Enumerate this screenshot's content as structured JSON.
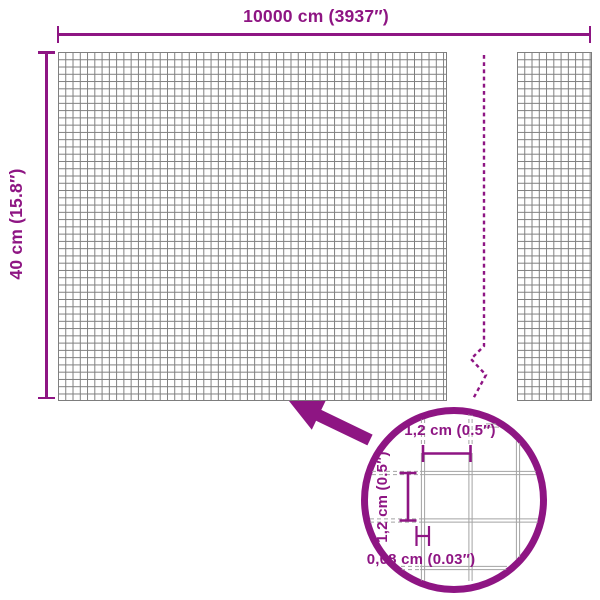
{
  "colors": {
    "brand": "#8e1583",
    "mesh-line": "#7d7d7d",
    "zoom-mesh-line": "#a3a3a3"
  },
  "diagram": {
    "product": "wire mesh fence roll",
    "width_label": "10000 cm (3937″)",
    "height_label": "40 cm (15.8″)",
    "zoom_callout": {
      "mesh_pitch_horizontal": "1,2 cm (0.5″)",
      "mesh_pitch_vertical": "1,2 cm (0.5″)",
      "wire_thickness": "0,08 cm (0.03″)"
    }
  }
}
